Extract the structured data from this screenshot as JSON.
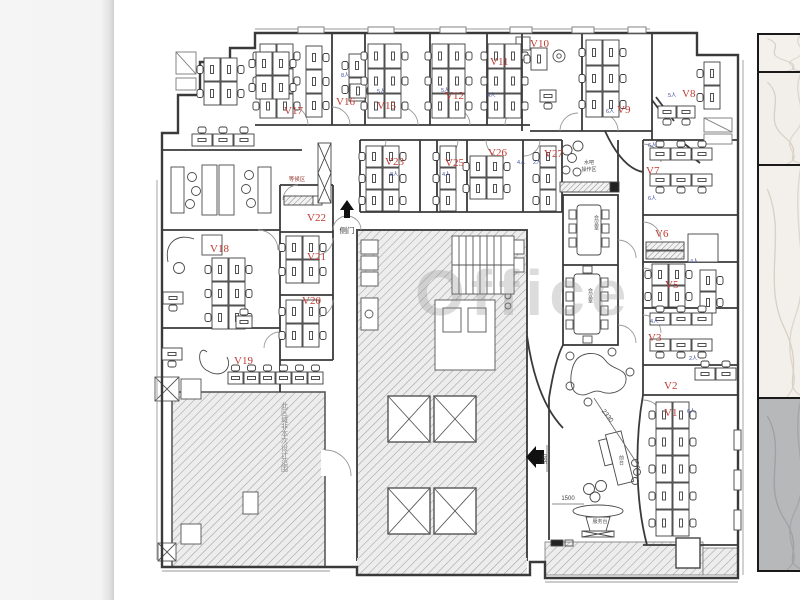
{
  "page": {
    "background": "#ffffff"
  },
  "left_panel": {
    "background": "#f5f5f5"
  },
  "watermark": {
    "text": "Office",
    "color": "#8f8f8f"
  },
  "floor_plan": {
    "label_color": "#bf3a30",
    "capacity_color": "#44519e",
    "room_labels": [
      {
        "id": "V1",
        "x": 664,
        "y": 416
      },
      {
        "id": "V2",
        "x": 664,
        "y": 389
      },
      {
        "id": "V3",
        "x": 648,
        "y": 341
      },
      {
        "id": "V5",
        "x": 665,
        "y": 288
      },
      {
        "id": "V6",
        "x": 655,
        "y": 237
      },
      {
        "id": "V7",
        "x": 646,
        "y": 174
      },
      {
        "id": "V8",
        "x": 682,
        "y": 97
      },
      {
        "id": "V9",
        "x": 617,
        "y": 113
      },
      {
        "id": "V10",
        "x": 530,
        "y": 47
      },
      {
        "id": "V11",
        "x": 490,
        "y": 65
      },
      {
        "id": "V12",
        "x": 445,
        "y": 99
      },
      {
        "id": "V15",
        "x": 377,
        "y": 109
      },
      {
        "id": "V16",
        "x": 336,
        "y": 105
      },
      {
        "id": "V17",
        "x": 284,
        "y": 114
      },
      {
        "id": "V18",
        "x": 210,
        "y": 252
      },
      {
        "id": "V19",
        "x": 234,
        "y": 364
      },
      {
        "id": "V20",
        "x": 302,
        "y": 304
      },
      {
        "id": "V21",
        "x": 307,
        "y": 260
      },
      {
        "id": "V22",
        "x": 307,
        "y": 221
      },
      {
        "id": "V23",
        "x": 385,
        "y": 165
      },
      {
        "id": "V25",
        "x": 445,
        "y": 166
      },
      {
        "id": "V26",
        "x": 488,
        "y": 156
      },
      {
        "id": "V27",
        "x": 544,
        "y": 157
      }
    ],
    "capacity_labels": [
      {
        "text": "8人",
        "x": 341,
        "y": 77
      },
      {
        "text": "5人",
        "x": 377,
        "y": 93
      },
      {
        "text": "5人",
        "x": 441,
        "y": 92
      },
      {
        "text": "4人",
        "x": 487,
        "y": 97
      },
      {
        "text": "6人",
        "x": 606,
        "y": 113
      },
      {
        "text": "5人",
        "x": 668,
        "y": 97
      },
      {
        "text": "8人",
        "x": 390,
        "y": 176
      },
      {
        "text": "4人",
        "x": 442,
        "y": 176
      },
      {
        "text": "4人",
        "x": 517,
        "y": 164
      },
      {
        "text": "2人",
        "x": 533,
        "y": 164
      },
      {
        "text": "6人",
        "x": 648,
        "y": 147
      },
      {
        "text": "6人",
        "x": 648,
        "y": 200
      },
      {
        "text": "4人",
        "x": 690,
        "y": 263
      },
      {
        "text": "4人",
        "x": 650,
        "y": 323
      },
      {
        "text": "2人",
        "x": 689,
        "y": 360
      },
      {
        "text": "6人",
        "x": 687,
        "y": 413
      }
    ],
    "annotations": [
      {
        "text": "侧门",
        "x": 347,
        "y": 233,
        "size": 7.5,
        "color": "#333333"
      },
      {
        "text": "等候区",
        "x": 297,
        "y": 181,
        "size": 5.5,
        "color": "#9a3c34"
      },
      {
        "text": "水吧",
        "x": 589,
        "y": 164,
        "size": 5,
        "color": "#444444"
      },
      {
        "text": "操作区",
        "x": 589,
        "y": 171,
        "size": 5,
        "color": "#444444"
      },
      {
        "text": "会议室",
        "x": 596,
        "y": 215,
        "size": 5,
        "color": "#555555",
        "vertical": true
      },
      {
        "text": "会议室",
        "x": 590,
        "y": 288,
        "size": 5,
        "color": "#555555",
        "vertical": true
      },
      {
        "text": "前台",
        "x": 621,
        "y": 455,
        "size": 5,
        "color": "#555555",
        "vertical": true
      },
      {
        "text": "服务台",
        "x": 600,
        "y": 523,
        "size": 5,
        "color": "#555555"
      },
      {
        "text": "此区域非本次设计范围",
        "x": 284,
        "y": 402,
        "size": 7,
        "color": "#8a8a8a",
        "vertical": true
      },
      {
        "text": "2330",
        "x": 606,
        "y": 417,
        "size": 6.5,
        "color": "#444444",
        "rotate": 52
      },
      {
        "text": "1500",
        "x": 568,
        "y": 500,
        "size": 6,
        "color": "#444444"
      },
      {
        "text": "580",
        "x": 547,
        "y": 459,
        "size": 6,
        "color": "#444444",
        "rotate": -90
      }
    ]
  },
  "right_panel": {
    "border_color": "#191919",
    "thumbnails": [
      {
        "name": "texture-thumbnail-1",
        "color": "#f4f1ed",
        "squiggle": "#d9d1c6",
        "height": 40
      },
      {
        "name": "texture-thumbnail-2",
        "color": "#f2efeb",
        "squiggle": "#d9d1c6",
        "height": 95
      },
      {
        "name": "texture-thumbnail-3",
        "color": "#f3f0ec",
        "squiggle": "#d9d1c6",
        "height": 235
      },
      {
        "name": "texture-thumbnail-4",
        "color": "#b7b8ba",
        "squiggle": "#9fa1a4",
        "height": 175
      }
    ]
  }
}
